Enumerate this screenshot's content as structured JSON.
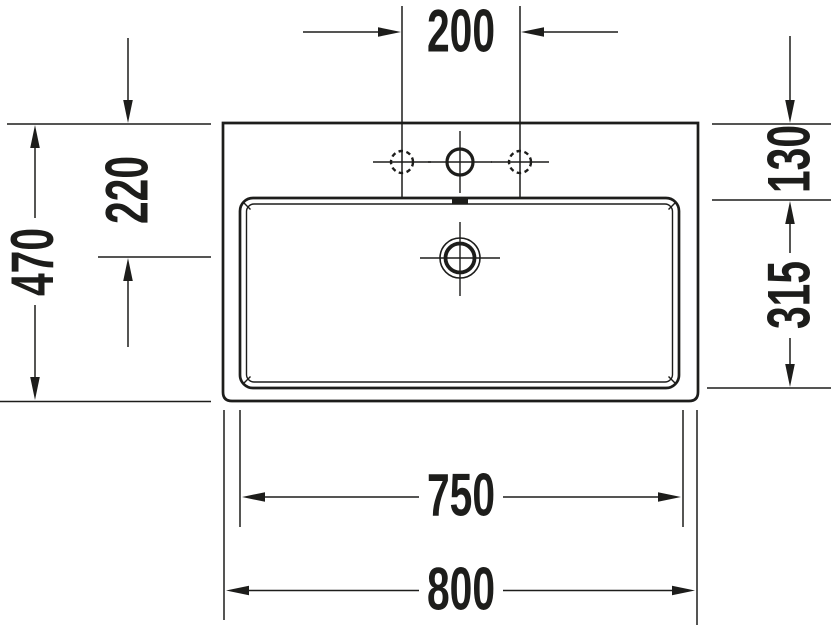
{
  "drawing": {
    "type": "washbasin-technical-drawing-top-view",
    "unit": "mm",
    "colors": {
      "line": "#1d1d1b",
      "background": "#ffffff"
    },
    "dimensions": {
      "faucet_hole_spacing": "200",
      "total_depth": "470",
      "rear_to_drain_center": "220",
      "rear_to_basin_edge": "130",
      "basin_inner_depth": "315",
      "basin_inner_width": "750",
      "total_width": "800"
    }
  }
}
